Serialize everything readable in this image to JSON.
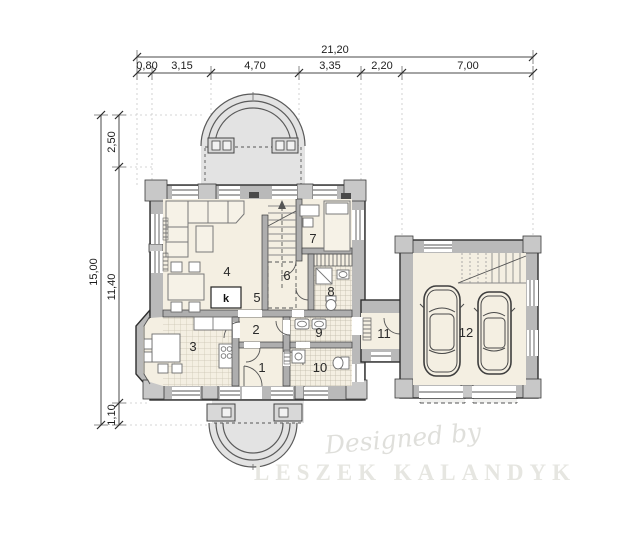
{
  "dimensions": {
    "top": {
      "total": "21,20",
      "segments": [
        "0,80",
        "3,15",
        "4,70",
        "3,35",
        "2,20",
        "7,00"
      ]
    },
    "left": {
      "total": "15,00",
      "segments": [
        "2,50",
        "11,40",
        "1,10"
      ]
    }
  },
  "room_labels": [
    "1",
    "2",
    "3",
    "4",
    "5",
    "6",
    "7",
    "8",
    "9",
    "10",
    "11",
    "12"
  ],
  "fireplace_label": "k",
  "watermark": {
    "line1": "Designed by",
    "line2": "LESZEK KALANDYK"
  },
  "colors": {
    "wall_fill": "#b9b9b9",
    "floor_fill": "#f4efe2",
    "terrace_fill": "#e3e3e3",
    "outline": "#2e2e2e",
    "dimension_line": "#4a4a4a",
    "watermark": "#e6e6e1"
  }
}
